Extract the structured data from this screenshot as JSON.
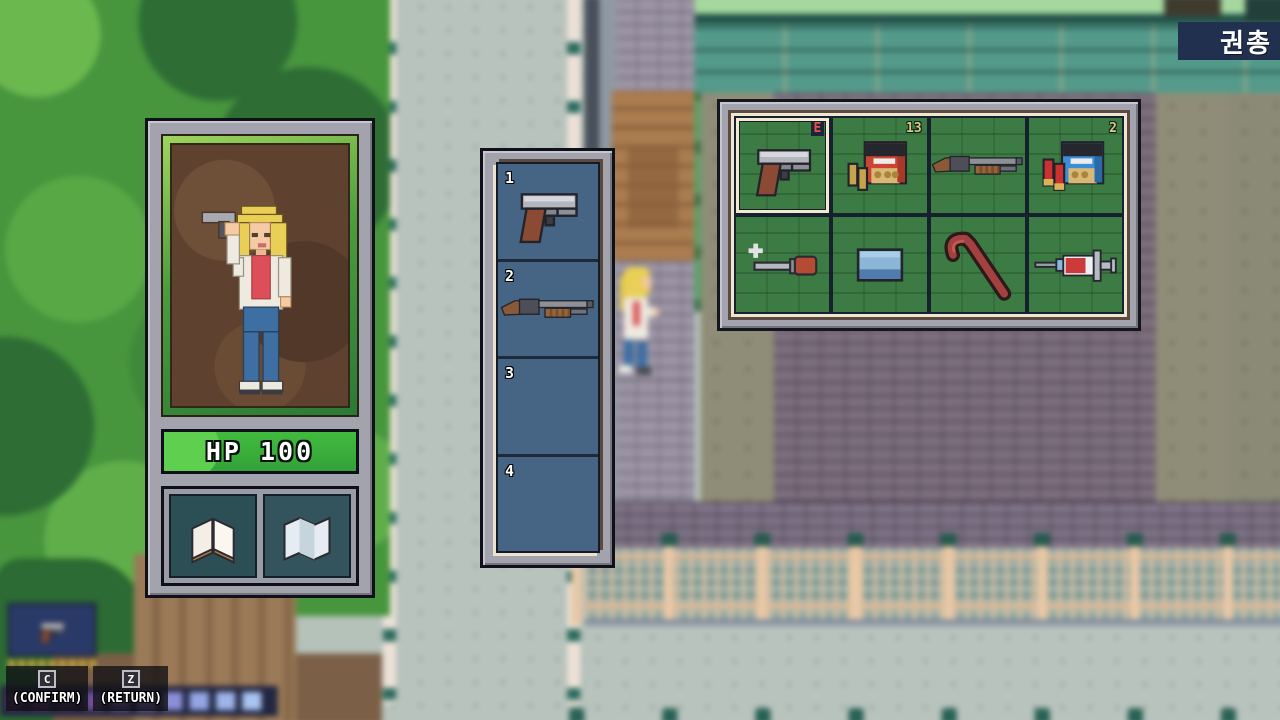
{
  "window": {
    "weapon_label": "권총"
  },
  "character_panel": {
    "hp_text": "HP 100",
    "portrait": "blonde-woman-holding-pistol",
    "item_slots": [
      "book",
      "map"
    ]
  },
  "hotbar": {
    "slots": [
      {
        "number": "1",
        "item": "pistol"
      },
      {
        "number": "2",
        "item": "shotgun"
      },
      {
        "number": "3",
        "item": ""
      },
      {
        "number": "4",
        "item": ""
      }
    ]
  },
  "inventory": {
    "slots": [
      {
        "item": "pistol",
        "badge": "E",
        "selected": true
      },
      {
        "item": "pistol-ammo-box",
        "count": "13"
      },
      {
        "item": "shotgun"
      },
      {
        "item": "shotgun-shell-box",
        "count": "2"
      },
      {
        "item": "screwdriver"
      },
      {
        "item": "soap"
      },
      {
        "item": "crowbar"
      },
      {
        "item": "syringe"
      }
    ]
  },
  "hud": {
    "equipped_weapon": "pistol",
    "ammo_pips": 9,
    "prompts": [
      {
        "key": "C",
        "label": "(CONFIRM)"
      },
      {
        "key": "Z",
        "label": "(RETURN)"
      }
    ]
  },
  "background": {
    "bar_colors": [
      "#4e2f63",
      "#5c3a77",
      "#4e2f63",
      "#6d4f97",
      "#7a62b2",
      "#8677c8",
      "#8c8fd8",
      "#93a5e4",
      "#9db4ea",
      "#a8c4f2"
    ]
  },
  "colors": {
    "hp_green": "#3fb83c",
    "slot_green": "#3c7b44",
    "selection_cream": "#f2ead0",
    "equipped_badge_red": "#e85050",
    "count_gold": "#d9c887",
    "label_navy": "#20304e"
  }
}
